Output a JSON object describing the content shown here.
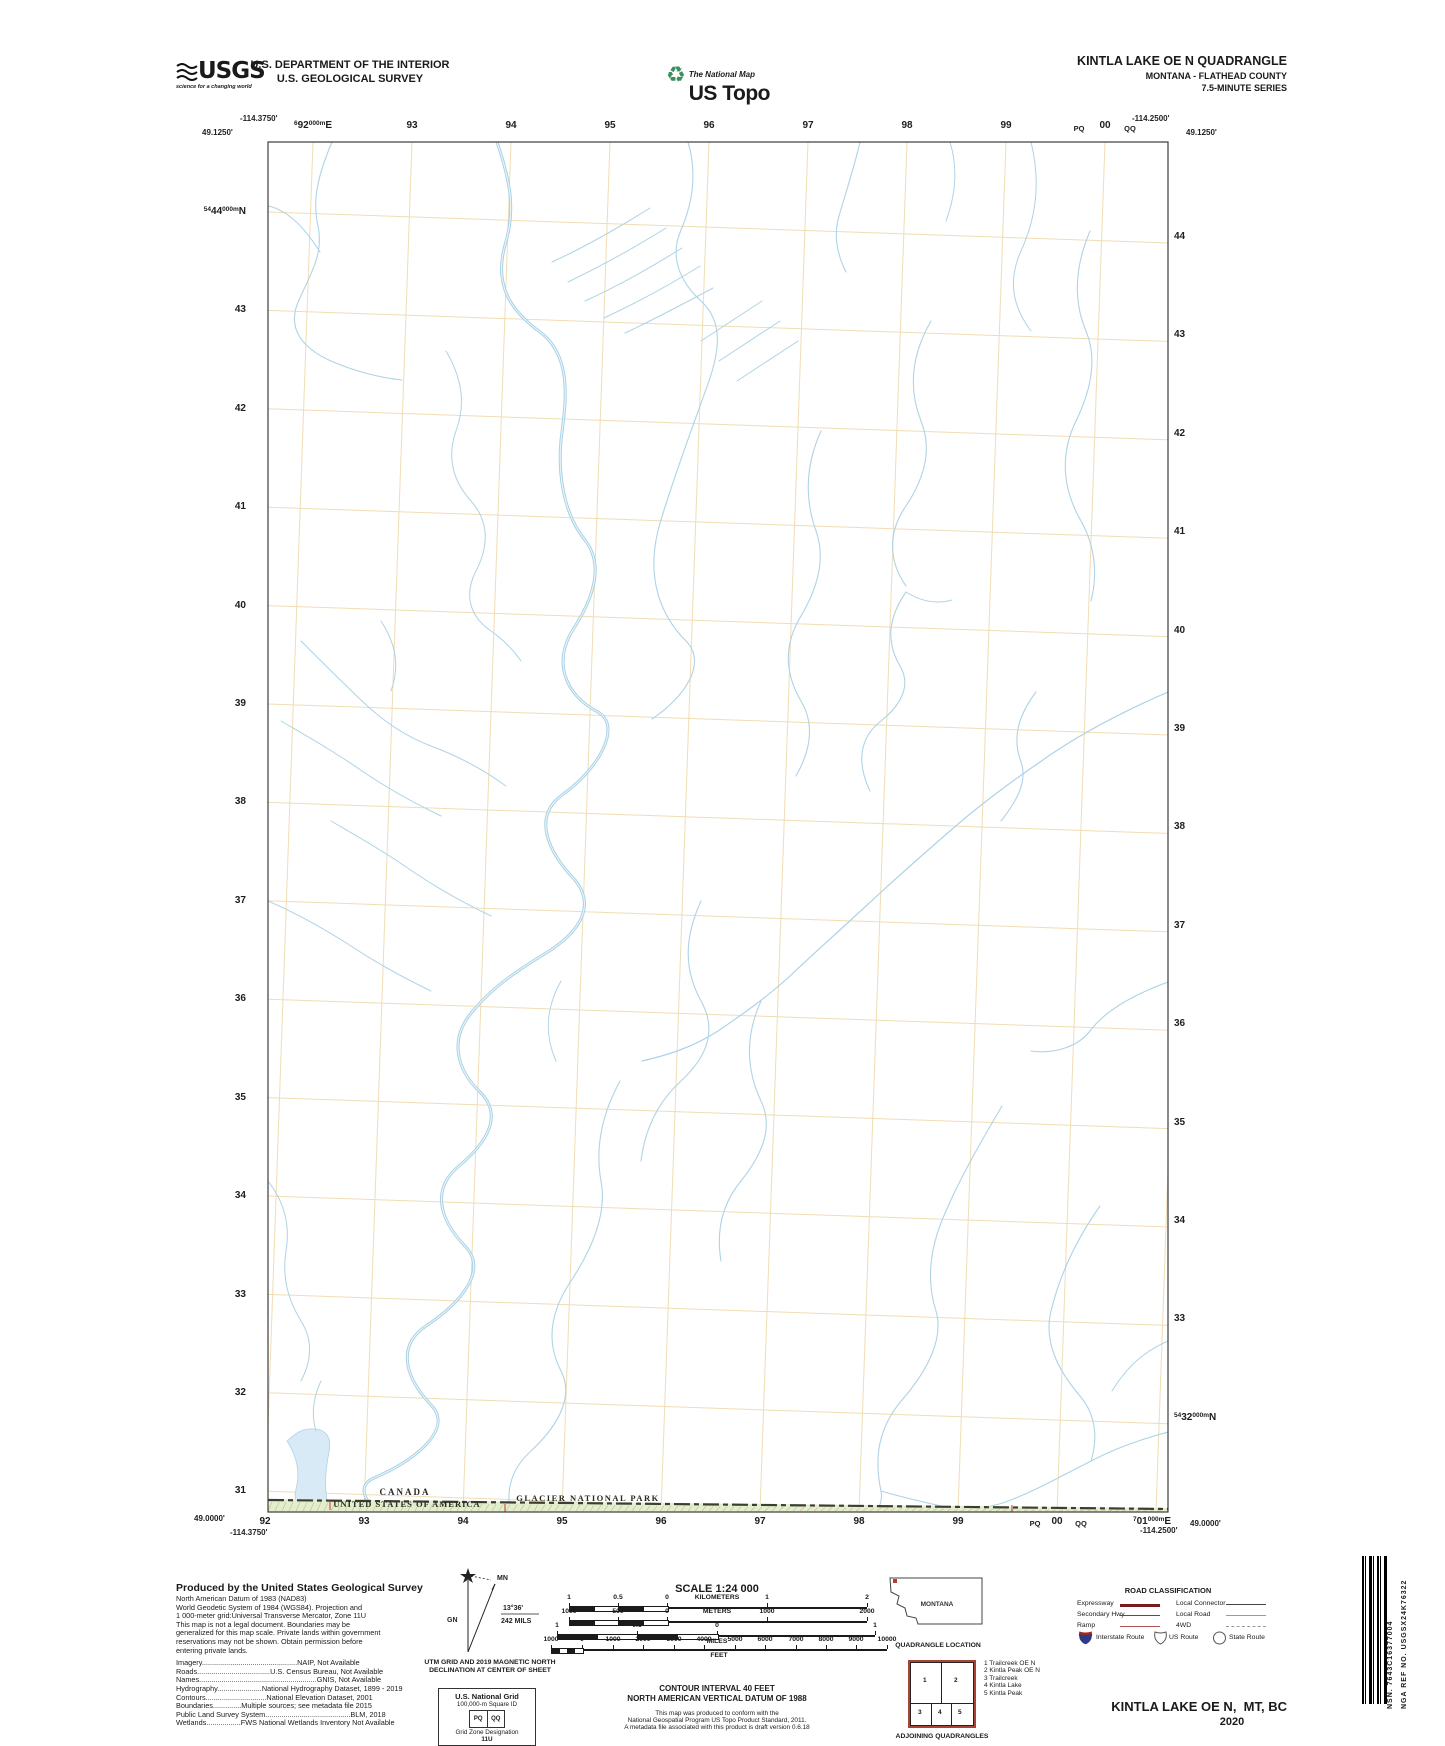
{
  "header": {
    "usgs": {
      "brand": "USGS",
      "tagline": "science for a changing world"
    },
    "dept_line1": "U.S. DEPARTMENT OF THE INTERIOR",
    "dept_line2": "U.S. GEOLOGICAL SURVEY",
    "ustopo": {
      "small": "The National Map",
      "big": "US Topo",
      "icon": "recycle-icon"
    },
    "title_line1": "KINTLA LAKE OE N QUADRANGLE",
    "title_line2": "MONTANA - FLATHEAD COUNTY",
    "title_line3": "7.5-MINUTE SERIES"
  },
  "map": {
    "corners": {
      "tl_lon": "-114.3750'",
      "tl_lat": "49.1250'",
      "tr_lon": "-114.2500'",
      "tr_lat": "49.1250'",
      "bl_lat": "49.0000'",
      "bl_lon": "-114.3750'",
      "br_lon": "-114.2500'",
      "br_lat": "49.0000'"
    },
    "grid": {
      "left": 268,
      "right": 1168,
      "top": 142,
      "bottom": 1512,
      "x0": 313,
      "xstep": 99,
      "xcount": 10,
      "xskew": -48,
      "y0": 212,
      "ystep": 98.4,
      "ycount": 14,
      "yskew": 31,
      "grid_color": "#f0ddb4",
      "neat_color": "#3c3c3c"
    },
    "edge_labels": {
      "top": [
        {
          "x": 313,
          "pre": "6",
          "big": "92",
          "sup": "000m",
          "post": "E"
        },
        {
          "x": 412,
          "big": "93"
        },
        {
          "x": 511,
          "big": "94"
        },
        {
          "x": 610,
          "big": "95"
        },
        {
          "x": 709,
          "big": "96"
        },
        {
          "x": 808,
          "big": "97"
        },
        {
          "x": 907,
          "big": "98"
        },
        {
          "x": 1006,
          "big": "99"
        },
        {
          "x": 1079,
          "big": "PQ",
          "small": true
        },
        {
          "x": 1105,
          "big": "00"
        },
        {
          "x": 1130,
          "big": "QQ",
          "small": true
        }
      ],
      "bottom": [
        {
          "x": 265,
          "big": "92"
        },
        {
          "x": 364,
          "big": "93"
        },
        {
          "x": 463,
          "big": "94"
        },
        {
          "x": 562,
          "big": "95"
        },
        {
          "x": 661,
          "big": "96"
        },
        {
          "x": 760,
          "big": "97"
        },
        {
          "x": 859,
          "big": "98"
        },
        {
          "x": 958,
          "big": "99"
        },
        {
          "x": 1035,
          "big": "PQ",
          "small": true
        },
        {
          "x": 1057,
          "big": "00"
        },
        {
          "x": 1081,
          "big": "QQ",
          "small": true
        },
        {
          "x": 1152,
          "pre": "7",
          "big": "01",
          "sup": "000m",
          "post": "E"
        }
      ],
      "left": [
        {
          "y": 206,
          "pre": "54",
          "big": "44",
          "sup": "000m",
          "post": "N"
        },
        {
          "y": 304,
          "big": "43"
        },
        {
          "y": 403,
          "big": "42"
        },
        {
          "y": 501,
          "big": "41"
        },
        {
          "y": 600,
          "big": "40"
        },
        {
          "y": 698,
          "big": "39"
        },
        {
          "y": 796,
          "big": "38"
        },
        {
          "y": 895,
          "big": "37"
        },
        {
          "y": 993,
          "big": "36"
        },
        {
          "y": 1092,
          "big": "35"
        },
        {
          "y": 1190,
          "big": "34"
        },
        {
          "y": 1289,
          "big": "33"
        },
        {
          "y": 1387,
          "big": "32"
        },
        {
          "y": 1485,
          "big": "31"
        }
      ],
      "right": [
        {
          "y": 231,
          "big": "44"
        },
        {
          "y": 329,
          "big": "43"
        },
        {
          "y": 428,
          "big": "42"
        },
        {
          "y": 526,
          "big": "41"
        },
        {
          "y": 625,
          "big": "40"
        },
        {
          "y": 723,
          "big": "39"
        },
        {
          "y": 821,
          "big": "38"
        },
        {
          "y": 920,
          "big": "37"
        },
        {
          "y": 1018,
          "big": "36"
        },
        {
          "y": 1117,
          "big": "35"
        },
        {
          "y": 1215,
          "big": "34"
        },
        {
          "y": 1313,
          "big": "33"
        },
        {
          "y": 1412,
          "pre": "54",
          "big": "32",
          "sup": "000m",
          "post": "N"
        }
      ]
    },
    "boundary": {
      "canada": "CANADA",
      "usa": "UNITED STATES OF AMERICA",
      "park": "GLACIER NATIONAL PARK",
      "red_mark": "6",
      "strip_fill": "#e2efcf",
      "hatch_color": "#cfb682",
      "line_color": "#3d3d33",
      "red_color": "#c0392b"
    },
    "water_color": "#aed3e6",
    "river_color": "#a5cfe4",
    "streams": [
      {
        "d": "M497,142 C510,180 516,210 505,245 C494,285 510,310 540,332 C572,356 566,400 562,432 C557,468 562,512 585,540 C605,566 592,600 574,628 C552,662 565,695 598,712 C622,726 600,768 562,795 C532,817 548,852 575,880 C596,906 580,932 546,953 C512,974 492,988 472,1012 C450,1038 455,1068 480,1092 C502,1114 490,1140 459,1166 C432,1188 438,1218 465,1246 C488,1270 462,1302 426,1326 C396,1346 405,1378 432,1406 C452,1428 420,1458 374,1478 C356,1486 366,1500 376,1513",
        "w": 3.0,
        "c": "#a5cfe4"
      },
      {
        "d": "M497,142 C510,180 516,210 505,245 C494,285 510,310 540,332 C572,356 566,400 562,432 C557,468 562,512 585,540 C605,566 592,600 574,628 C552,662 565,695 598,712 C622,726 600,768 562,795 C532,817 548,852 575,880 C596,906 580,932 546,953 C512,974 492,988 472,1012 C450,1038 455,1068 480,1092 C502,1114 490,1140 459,1166 C432,1188 438,1218 465,1246 C488,1270 462,1302 426,1326 C396,1346 405,1378 432,1406 C452,1428 420,1458 374,1478 C356,1486 366,1500 376,1513",
        "w": 1.2,
        "c": "#e8f4fa"
      },
      {
        "d": "M332,142 C318,175 312,200 318,226 C324,254 310,275 299,300 C286,328 302,348 331,361 C356,372 382,378 402,380",
        "w": 1.1
      },
      {
        "d": "M268,206 C288,210 305,228 320,252",
        "w": 1.1
      },
      {
        "d": "M552,262 C585,247 618,228 650,208",
        "w": 1
      },
      {
        "d": "M568,282 C601,266 634,248 666,228",
        "w": 1
      },
      {
        "d": "M585,301 C618,286 650,268 682,248",
        "w": 1
      },
      {
        "d": "M604,318 C636,303 668,286 700,266",
        "w": 1
      },
      {
        "d": "M625,333 C655,319 685,303 713,288",
        "w": 1
      },
      {
        "d": "M688,142 C697,172 693,202 681,230 C670,255 678,280 701,301 C724,322 719,352 709,381 C696,418 676,470 661,520 C646,568 655,610 686,641 C708,663 684,698 652,719",
        "w": 1.1
      },
      {
        "d": "M860,142 C854,168 846,192 839,216 C833,236 838,256 846,272",
        "w": 1.1
      },
      {
        "d": "M1168,692 C1122,712 1076,736 1040,762 C1005,786 976,808 950,831 C921,856 894,880 866,906 C838,932 812,955 790,976 C766,998 740,1016 718,1031 C692,1048 664,1056 642,1061",
        "w": 1.2
      },
      {
        "d": "M906,592 C888,618 886,642 900,666 C912,686 900,706 881,721 C860,737 856,762 870,791",
        "w": 1.1
      },
      {
        "d": "M906,592 C922,602 938,604 952,600",
        "w": 1
      },
      {
        "d": "M1168,982 C1130,996 1104,1012 1090,1031 C1077,1048 1052,1054 1031,1051",
        "w": 1.1
      },
      {
        "d": "M1036,692 C1018,716 1012,738 1021,762 C1028,782 1016,802 1001,821",
        "w": 1.1
      },
      {
        "d": "M1002,1106 C982,1140 962,1174 946,1211 C930,1246 926,1280 936,1311 C944,1338 928,1370 902,1400 C878,1428 874,1458 881,1491 C883,1500 879,1508 876,1513",
        "w": 1.1
      },
      {
        "d": "M1100,1206 C1076,1240 1060,1274 1051,1311 C1044,1340 1056,1368 1080,1396 C1096,1415 1098,1438 1091,1461",
        "w": 1.1
      },
      {
        "d": "M1168,1432 C1138,1440 1112,1450 1091,1461 C1062,1476 1036,1490 1011,1500 C986,1510 962,1510 941,1506 C919,1501 898,1496 881,1491",
        "w": 1.1
      },
      {
        "d": "M301,641 C322,662 342,682 362,701 C386,724 410,738 431,746 C458,756 484,770 506,786",
        "w": 1
      },
      {
        "d": "M281,721 C310,738 338,754 362,771 C390,790 416,804 441,816",
        "w": 1
      },
      {
        "d": "M331,821 C360,838 388,854 412,871 C440,890 466,904 491,916",
        "w": 1
      },
      {
        "d": "M268,901 C298,914 326,930 351,946 C378,964 404,978 431,991",
        "w": 1
      },
      {
        "d": "M381,621 C396,644 400,666 391,691",
        "w": 1
      },
      {
        "d": "M620,1081 C602,1114 595,1148 601,1181 C607,1212 594,1246 571,1281 C550,1312 546,1342 561,1371 C573,1394 562,1422 531,1451 C512,1468 505,1490 511,1513",
        "w": 1.1
      },
      {
        "d": "M701,901 C686,934 682,966 701,1001 C716,1028 710,1054 681,1081 C658,1102 645,1128 641,1161",
        "w": 1.1
      },
      {
        "d": "M761,1001 C746,1034 745,1067 761,1101 C773,1126 764,1152 741,1181 C722,1204 716,1231 721,1261",
        "w": 1.1
      },
      {
        "d": "M950,142 C958,168 956,194 946,221",
        "w": 1
      },
      {
        "d": "M1031,142 C1040,178 1038,214 1021,251 C1008,280 1012,306 1031,331",
        "w": 1
      },
      {
        "d": "M1090,231 C1076,264 1072,298 1086,331 C1097,357 1092,388 1076,421 C1060,454 1062,488 1081,521 C1095,546 1098,574 1091,601",
        "w": 1.1
      },
      {
        "d": "M931,321 C912,354 908,388 921,421 C932,448 926,476 906,506 C888,532 888,560 906,586",
        "w": 1.1
      },
      {
        "d": "M821,431 C806,464 804,497 816,531 C825,556 820,584 801,616 C784,644 784,672 801,701 C814,723 812,748 796,776",
        "w": 1.1
      },
      {
        "d": "M701,341 C722,327 742,314 762,301",
        "w": 1
      },
      {
        "d": "M719,361 C740,347 760,334 780,321",
        "w": 1
      },
      {
        "d": "M737,381 C758,367 778,354 798,341",
        "w": 1
      },
      {
        "d": "M446,351 C462,378 466,404 456,431 C447,456 452,480 471,501 C488,520 490,544 476,571 C464,594 469,616 491,631 C501,638 512,648 521,661",
        "w": 1
      },
      {
        "d": "M561,981 C546,1008 544,1034 556,1061",
        "w": 1
      },
      {
        "d": "M268,1181 C286,1204 290,1228 286,1251 C282,1276 287,1298 301,1321 C313,1340 312,1360 301,1381",
        "w": 1
      },
      {
        "d": "M321,1381 C313,1398 311,1414 316,1431",
        "w": 1
      },
      {
        "d": "M1168,1341 C1148,1350 1130,1362 1112,1391",
        "w": 1
      }
    ],
    "wetland": {
      "d": "M287,1441 C298,1458 300,1474 296,1489 C293,1500 298,1508 306,1512 L331,1513 C323,1494 325,1472 329,1452 C332,1438 326,1430 316,1429 C303,1428 297,1432 287,1441 Z",
      "fill": "#d7eaf5"
    }
  },
  "footer": {
    "credits": {
      "heading": "Produced by the United States Geological Survey",
      "lines": [
        "North American Datum of 1983 (NAD83)",
        "World Geodetic System of 1984 (WGS84).  Projection and",
        "1 000-meter grid:Universal Transverse Mercator, Zone 11U",
        "This map is not a legal document. Boundaries may be",
        "generalized for this map scale. Private lands within government",
        "reservations may not be shown. Obtain permission before",
        "entering private lands.",
        "",
        "Imagery...............................................NAIP,  Not  Available",
        "Roads....................................U.S.  Census  Bureau,  Not  Available",
        "Names..........................................................GNIS,  Not  Available",
        "Hydrography......................National  Hydrography  Dataset,  1899  -  2019",
        "Contours..............................National  Elevation  Dataset,  2001",
        "Boundaries..............Multiple  sources;  see  metadata  file  2015",
        "Public  Land  Survey  System..........................................BLM,  2018",
        "Wetlands.................FWS  National  Wetlands  Inventory  Not  Available"
      ]
    },
    "declination": {
      "mn": "MN",
      "gn": "GN",
      "deg": "13°36'",
      "mils": "242 MILS",
      "cap1": "UTM GRID AND 2019 MAGNETIC NORTH",
      "cap2": "DECLINATION AT CENTER OF SHEET"
    },
    "scale": {
      "title": "SCALE 1:24 000",
      "bars": [
        {
          "y": 1607,
          "zero": 667,
          "seg": -98,
          "ticks": [
            [
              "1",
              -98
            ],
            [
              "0.5",
              -49
            ],
            [
              "0",
              0
            ],
            [
              "1",
              100
            ],
            [
              "2",
              200
            ]
          ],
          "inline": "KILOMETERS",
          "inline_x": 50
        },
        {
          "y": 1621,
          "zero": 667,
          "seg": -98,
          "ticks": [
            [
              "1000",
              -98
            ],
            [
              "500",
              -49
            ],
            [
              "0",
              0
            ],
            [
              "1000",
              100
            ],
            [
              "2000",
              200
            ]
          ],
          "inline": "METERS",
          "inline_x": 50
        },
        {
          "y": 1635,
          "zero": 717,
          "seg": -160,
          "ticks": [
            [
              "1",
              -160
            ],
            [
              "0.5",
              -80
            ],
            [
              "0",
              0
            ],
            [
              "1",
              158
            ]
          ],
          "below": "MILES",
          "below_x": 0
        },
        {
          "y": 1649,
          "zero": 582,
          "seg": -31,
          "ticks": [
            [
              "1000",
              -31
            ],
            [
              "0",
              0
            ],
            [
              "1000",
              31
            ],
            [
              "2000",
              61
            ],
            [
              "3000",
              92
            ],
            [
              "4000",
              122
            ],
            [
              "5000",
              153
            ],
            [
              "6000",
              183
            ],
            [
              "7000",
              214
            ],
            [
              "8000",
              244
            ],
            [
              "9000",
              274
            ],
            [
              "10000",
              305
            ]
          ],
          "below": "FEET",
          "below_x": 137
        }
      ]
    },
    "contour": {
      "line1": "CONTOUR INTERVAL 40 FEET",
      "line2": "NORTH AMERICAN VERTICAL DATUM OF 1988",
      "notes": [
        "This map was produced to conform with the",
        "National Geospatial Program US Topo Product Standard, 2011.",
        "A metadata file associated with this product is draft version 0.6.18"
      ]
    },
    "usng": {
      "t1": "U.S. National Grid",
      "t2": "100,000-m Square ID",
      "sq_left": "PQ",
      "sq_right": "QQ",
      "t3": "Grid Zone Designation",
      "t4": "11U"
    },
    "location": {
      "state": "MONTANA",
      "caption": "QUADRANGLE LOCATION",
      "marker_color": "#c0392b"
    },
    "adjoining": {
      "nums": [
        "1",
        "2",
        "3",
        "4",
        "5"
      ],
      "list": [
        "1 Trailcreek OE N",
        "2 Kintla Peak OE N",
        "3 Trailcreek",
        "4 Kintla Lake",
        "5 Kintla Peak"
      ],
      "caption": "ADJOINING QUADRANGLES"
    },
    "roads": {
      "title": "ROAD CLASSIFICATION",
      "rows": [
        {
          "l": "Expressway",
          "ls": "expressway",
          "r": "Local Connector",
          "rs": "connector"
        },
        {
          "l": "Secondary Hwy",
          "ls": "secondary",
          "r": "Local Road",
          "rs": "local"
        },
        {
          "l": "Ramp",
          "ls": "ramp",
          "r": "4WD",
          "rs": "fourwd"
        }
      ],
      "shields": [
        {
          "k": "interstate",
          "label": "Interstate Route"
        },
        {
          "k": "us",
          "label": "US Route"
        },
        {
          "k": "state",
          "label": "State Route"
        }
      ],
      "interstate_blue": "#2b3a8c",
      "interstate_red": "#a5281f"
    },
    "title_block": {
      "title": "KINTLA LAKE OE N,  MT, BC",
      "year": "2020"
    },
    "barcode": {
      "nsn_label": "NSN.",
      "nsn": "7643C16377004",
      "nga_label": "NGA REF NO.",
      "nga": "USGSX24K76322"
    }
  }
}
